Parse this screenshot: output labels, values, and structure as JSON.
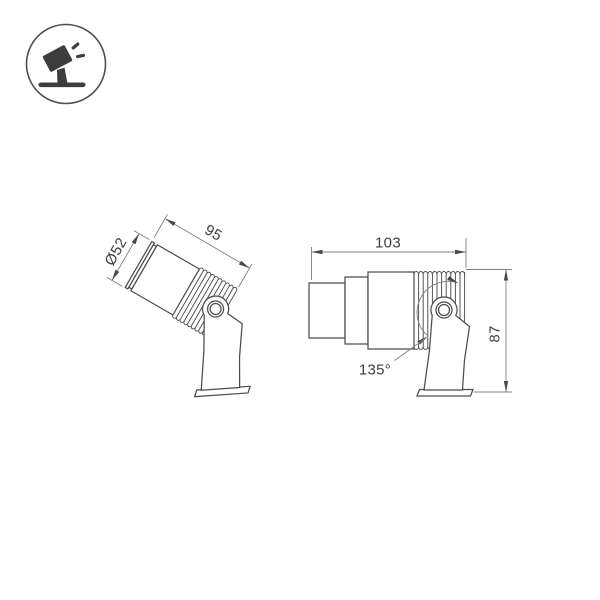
{
  "icon": {
    "name": "tilted-spotlight-pictogram",
    "description": "spotlight on stand tilted with light rays, inside circle"
  },
  "views": {
    "perspective": {
      "dim_diameter": "Ø52",
      "dim_length": "95"
    },
    "side": {
      "dim_width": "103",
      "dim_height": "87",
      "dim_angle": "135°"
    }
  },
  "colors": {
    "background": "#ffffff",
    "outline": "#4d4d4d",
    "dimension_lines": "#808080",
    "dimension_text": "#3f3f3f",
    "icon_glyph": "#3d3d3d"
  }
}
